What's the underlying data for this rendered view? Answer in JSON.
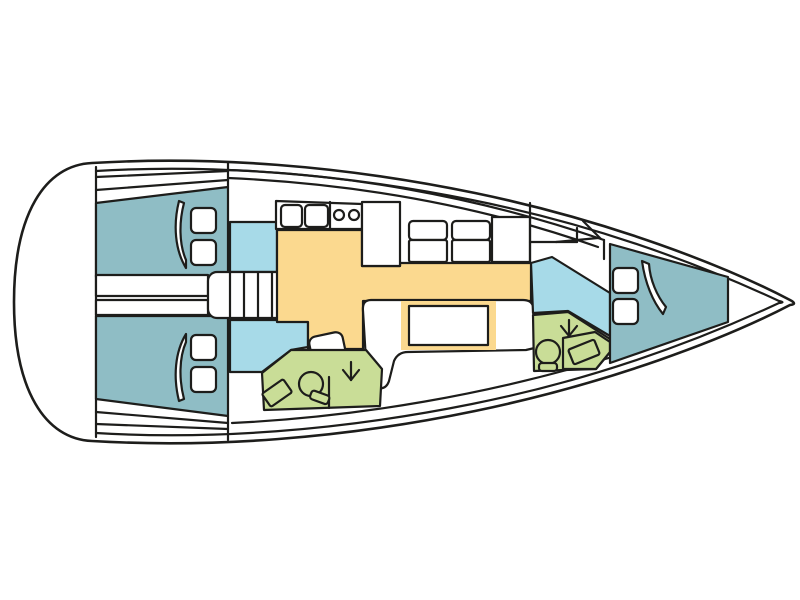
{
  "page": {
    "background": "#ffffff"
  },
  "palette": {
    "line": "#1d1d1b",
    "hull_white": "#ffffff",
    "cabin_teal": "#8fbdc5",
    "passage_blue": "#a7dae8",
    "saloon_yellow": "#fbd98f",
    "head_green": "#c9dd97",
    "furniture_white": "#ffffff"
  },
  "diagram": {
    "type": "sailboat-interior-layout-top-view",
    "orientation": "bow-right-stern-left",
    "regions": [
      {
        "name": "aft-cabin-port",
        "fill_key": "cabin_teal",
        "features": [
          "double-berth",
          "pillows-x2",
          "mattress-split-line"
        ]
      },
      {
        "name": "aft-cabin-starboard",
        "fill_key": "cabin_teal",
        "features": [
          "double-berth",
          "pillows-x2",
          "mattress-split-line"
        ]
      },
      {
        "name": "companionway-steps",
        "fill_key": "furniture_white",
        "features": [
          "treads-x7"
        ]
      },
      {
        "name": "companionway-landing-upper",
        "fill_key": "passage_blue"
      },
      {
        "name": "companionway-landing-lower",
        "fill_key": "passage_blue"
      },
      {
        "name": "galley",
        "fill_key": "furniture_white",
        "features": [
          "double-sink",
          "stove-burners-x2",
          "fridge-column"
        ]
      },
      {
        "name": "dinette",
        "fill_key": "furniture_white",
        "features": [
          "seats-x2",
          "nav-table"
        ]
      },
      {
        "name": "saloon-floor",
        "fill_key": "saloon_yellow",
        "features": [
          "settee-sofa",
          "saloon-table",
          "bench"
        ]
      },
      {
        "name": "aft-head",
        "fill_key": "head_green",
        "features": [
          "toilet",
          "washbasin",
          "shower-arrow"
        ]
      },
      {
        "name": "forward-passage",
        "fill_key": "passage_blue"
      },
      {
        "name": "forward-head",
        "fill_key": "head_green",
        "features": [
          "toilet",
          "washbasin",
          "shower-arrow"
        ]
      },
      {
        "name": "forward-cabin",
        "fill_key": "cabin_teal",
        "features": [
          "v-berth",
          "pillows-x2",
          "mattress-split-line"
        ]
      }
    ]
  }
}
